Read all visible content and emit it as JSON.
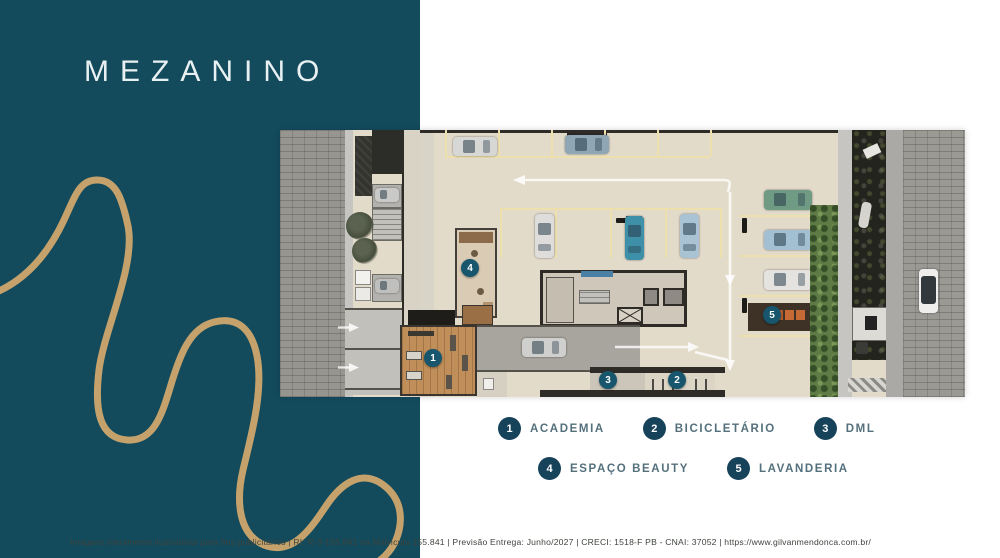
{
  "slide": {
    "title": "MEZANINO",
    "colors": {
      "panel_teal": "#134b5d",
      "accent_gold": "#c5a26b",
      "legend_circle": "#16425a",
      "legend_label_text": "#54707c",
      "plan_floor_beige": "#e3dbca",
      "marker_teal": "#17566c"
    }
  },
  "legend": {
    "items": [
      {
        "number": "1",
        "label": "ACADEMIA"
      },
      {
        "number": "2",
        "label": "BICICLETÁRIO"
      },
      {
        "number": "3",
        "label": "DML"
      },
      {
        "number": "4",
        "label": "ESPAÇO BEAUTY"
      },
      {
        "number": "5",
        "label": "LAVANDERIA"
      }
    ]
  },
  "plan": {
    "markers": [
      {
        "number": "1"
      },
      {
        "number": "2"
      },
      {
        "number": "3"
      },
      {
        "number": "4"
      },
      {
        "number": "5"
      }
    ]
  },
  "footer": {
    "text": "Imagens meramente ilustrativas para fins publicitários | RI: R-3-155.841 na Matrícula 155.841 | Previsão Entrega: Junho/2027 | CRECI: 1518-F PB - CNAI: 37052 | https://www.gilvanmendonca.com.br/"
  }
}
